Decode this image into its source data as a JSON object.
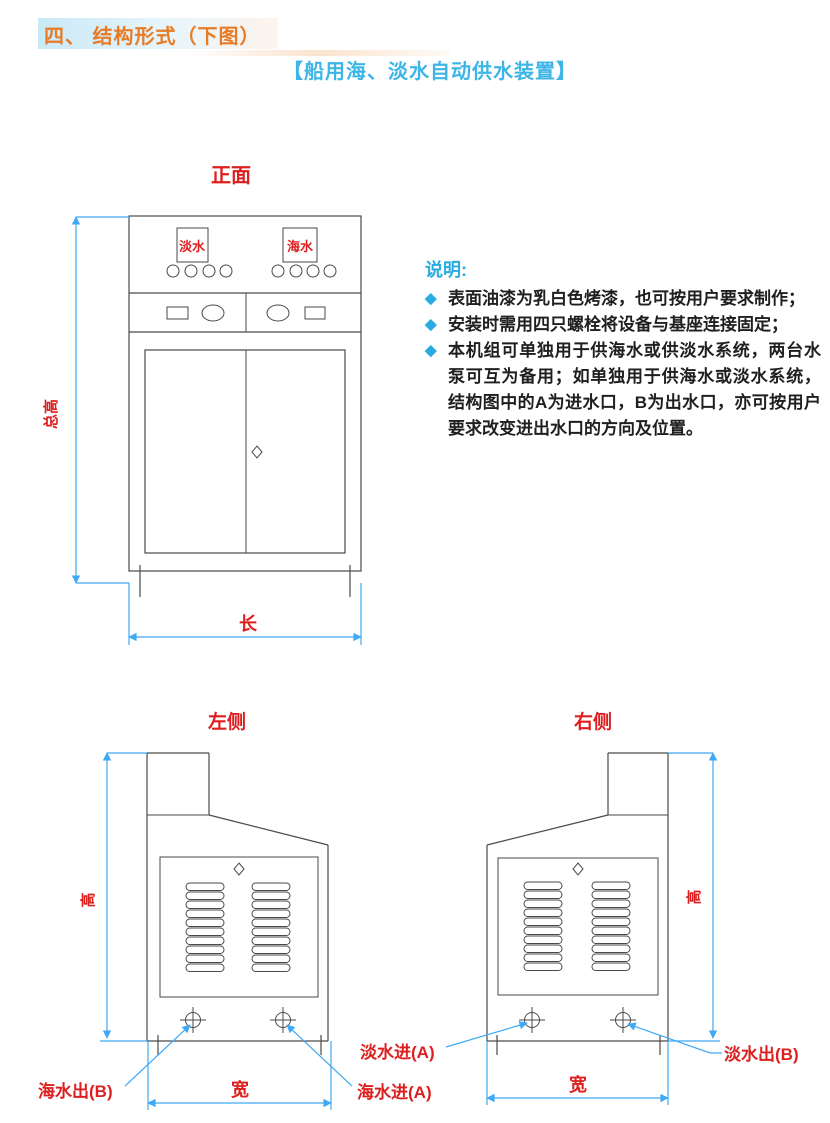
{
  "page": {
    "header": "四、 结构形式（下图）",
    "title": "【船用海、淡水自动供水装置】"
  },
  "notes": {
    "heading": "说明:",
    "bullet": "◆",
    "items": [
      "表面油漆为乳白色烤漆，也可按用户要求制作；",
      "安装时需用四只螺栓将设备与基座连接固定；",
      "本机组可单独用于供海水或供淡水系统，两台水泵可互为备用；如单独用于供海水或淡水系统，结构图中的A为进水口，B为出水口，亦可按用户要求改变进出水口的方向及位置。"
    ]
  },
  "front_view": {
    "label": "正面",
    "display_left": "淡水",
    "display_right": "海水",
    "dim_height": "总高",
    "dim_length": "长"
  },
  "left_view": {
    "label": "左侧",
    "dim_height": "高",
    "dim_width": "宽",
    "port_left": "海水出(B)",
    "port_right": "海水进(A)"
  },
  "right_view": {
    "label": "右侧",
    "dim_height": "高",
    "dim_width": "宽",
    "port_left": "淡水进(A)",
    "port_right": "淡水出(B)"
  },
  "colors": {
    "accent_blue": "#29abe2",
    "dimension_blue": "#3fa9f5",
    "label_red": "#dd1f1f",
    "header_orange": "#e87c26",
    "line_dark": "#4a4a4a"
  }
}
